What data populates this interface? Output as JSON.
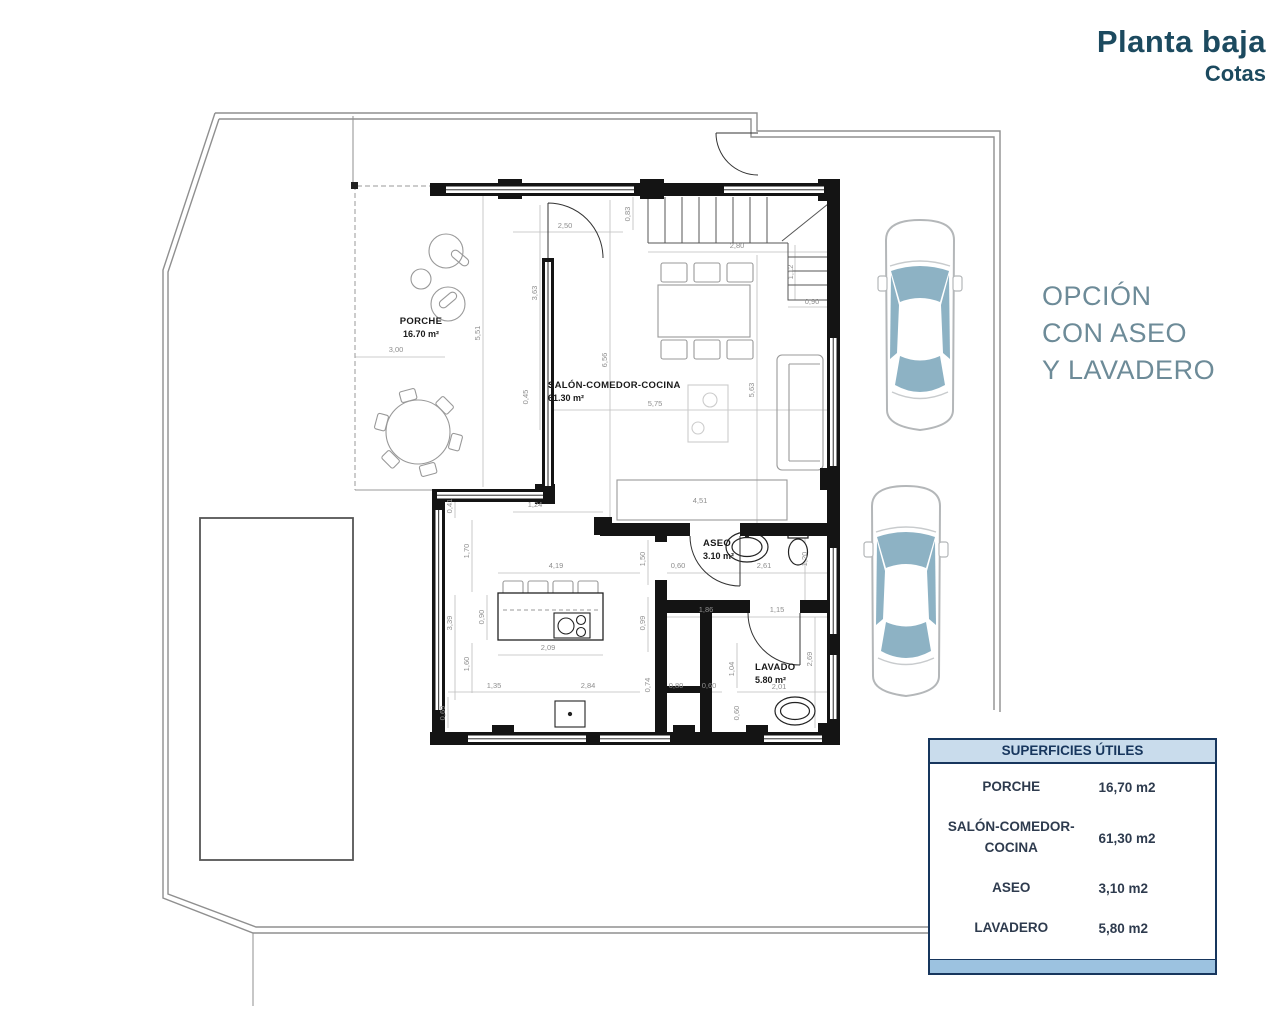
{
  "title": {
    "line1": "Planta baja",
    "line2": "Cotas",
    "color": "#1c4a5f"
  },
  "option_note": {
    "lines": [
      "OPCIÓN",
      "CON ASEO",
      "Y LAVADERO"
    ],
    "color": "#6d8b98"
  },
  "surfaces_table": {
    "header": "SUPERFICIES ÚTILES",
    "rows": [
      {
        "label_lines": [
          "PORCHE"
        ],
        "value": "16,70 m2"
      },
      {
        "label_lines": [
          "SALÓN-COMEDOR-",
          "COCINA"
        ],
        "value": "61,30 m2"
      },
      {
        "label_lines": [
          "ASEO"
        ],
        "value": "3,10 m2"
      },
      {
        "label_lines": [
          "LAVADERO"
        ],
        "value": "5,80 m2"
      }
    ],
    "border_color": "#17365d",
    "header_bg": "#c9dcec",
    "header_color": "#17365d",
    "row_color": "#2e3b4e",
    "footer_bg": "#9cc2e0"
  },
  "plan": {
    "room_labels": [
      {
        "name": "PORCHE",
        "area": "16.70 m²",
        "x": 421,
        "y": 324,
        "anchor": "middle"
      },
      {
        "name": "SALÓN-COMEDOR-COCINA",
        "area": "61.30 m²",
        "x": 548,
        "y": 388,
        "anchor": "start"
      },
      {
        "name": "ASEO",
        "area": "3.10 m²",
        "x": 703,
        "y": 546,
        "anchor": "start"
      },
      {
        "name": "LAVADO",
        "area": "5.80 m²",
        "x": 755,
        "y": 670,
        "anchor": "start"
      }
    ],
    "dim_labels": [
      {
        "t": "2,50",
        "x": 565,
        "y": 228,
        "r": 0
      },
      {
        "t": "0,83",
        "x": 630,
        "y": 214,
        "r": 1
      },
      {
        "t": "2,80",
        "x": 737,
        "y": 248,
        "r": 0
      },
      {
        "t": "1,12",
        "x": 793,
        "y": 272,
        "r": 1
      },
      {
        "t": "0,90",
        "x": 812,
        "y": 304,
        "r": 0
      },
      {
        "t": "3,00",
        "x": 396,
        "y": 352,
        "r": 0
      },
      {
        "t": "5,51",
        "x": 480,
        "y": 333,
        "r": 1
      },
      {
        "t": "3,63",
        "x": 537,
        "y": 293,
        "r": 1
      },
      {
        "t": "6,56",
        "x": 607,
        "y": 360,
        "r": 1
      },
      {
        "t": "5,63",
        "x": 754,
        "y": 390,
        "r": 1
      },
      {
        "t": "5,75",
        "x": 655,
        "y": 406,
        "r": 0
      },
      {
        "t": "0,45",
        "x": 528,
        "y": 397,
        "r": 1
      },
      {
        "t": "1,24",
        "x": 535,
        "y": 507,
        "r": 0
      },
      {
        "t": "4,51",
        "x": 700,
        "y": 503,
        "r": 0
      },
      {
        "t": "0,41",
        "x": 452,
        "y": 506,
        "r": 1
      },
      {
        "t": "1,70",
        "x": 469,
        "y": 551,
        "r": 1
      },
      {
        "t": "3,39",
        "x": 452,
        "y": 623,
        "r": 1
      },
      {
        "t": "0,90",
        "x": 484,
        "y": 617,
        "r": 1
      },
      {
        "t": "1,60",
        "x": 469,
        "y": 664,
        "r": 1
      },
      {
        "t": "0,69",
        "x": 445,
        "y": 713,
        "r": 1
      },
      {
        "t": "4,19",
        "x": 556,
        "y": 568,
        "r": 0
      },
      {
        "t": "1,50",
        "x": 645,
        "y": 559,
        "r": 1
      },
      {
        "t": "0,60",
        "x": 678,
        "y": 568,
        "r": 0
      },
      {
        "t": "2,61",
        "x": 764,
        "y": 568,
        "r": 0
      },
      {
        "t": "1,20",
        "x": 807,
        "y": 559,
        "r": 1
      },
      {
        "t": "0,99",
        "x": 645,
        "y": 623,
        "r": 1
      },
      {
        "t": "1,86",
        "x": 706,
        "y": 612,
        "r": 0
      },
      {
        "t": "1,15",
        "x": 777,
        "y": 612,
        "r": 0
      },
      {
        "t": "2,09",
        "x": 548,
        "y": 650,
        "r": 0
      },
      {
        "t": "1,04",
        "x": 734,
        "y": 669,
        "r": 1
      },
      {
        "t": "2,69",
        "x": 812,
        "y": 659,
        "r": 1
      },
      {
        "t": "1,35",
        "x": 494,
        "y": 688,
        "r": 0
      },
      {
        "t": "2,84",
        "x": 588,
        "y": 688,
        "r": 0
      },
      {
        "t": "0,74",
        "x": 650,
        "y": 685,
        "r": 1
      },
      {
        "t": "0,80",
        "x": 676,
        "y": 688,
        "r": 0
      },
      {
        "t": "0,60",
        "x": 709,
        "y": 688,
        "r": 0
      },
      {
        "t": "2,01",
        "x": 779,
        "y": 689,
        "r": 0
      },
      {
        "t": "0,60",
        "x": 739,
        "y": 713,
        "r": 1
      }
    ],
    "colors": {
      "wall": "#141414",
      "boundary": "#8f8f8f",
      "dim": "#8f8f8f",
      "furniture": "#999999",
      "car_outline": "#b4b7b9",
      "car_glass": "#8db2c4"
    }
  }
}
